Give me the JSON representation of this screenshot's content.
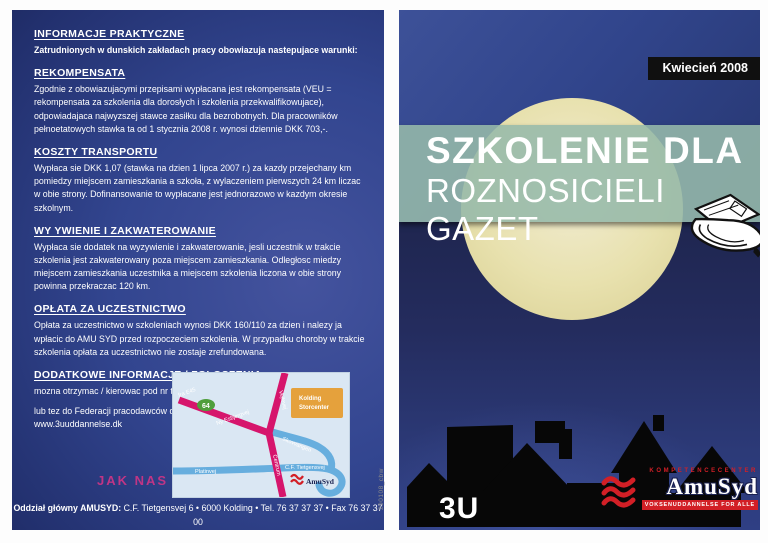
{
  "left_page": {
    "sections": [
      {
        "heading": "INFORMACJE PRAKTYCZNE",
        "body": "Zatrudnionych w dunskich zakładach pracy obowiazuja nastepujace warunki:"
      },
      {
        "heading": "REKOMPENSATA",
        "body": "Zgodnie z obowiazujacymi przepisami wypłacana jest rekompensata (VEU = rekompensata za szkolenia dla dorosłych i szkolenia przekwalifikowujace), odpowiadajaca najwyzszej stawce zasiłku dla bezrobotnych. Dla pracowników pełnoetatowych stawka ta od 1 stycznia 2008 r. wynosi dziennie DKK 703,-."
      },
      {
        "heading": "KOSZTY TRANSPORTU",
        "body": "Wypłaca sie DKK 1,07 (stawka na dzien 1 lipca 2007 r.) za kazdy przejechany km pomiedzy miejscem zamieszkania a szkoła, z wylaczeniem pierwszych 24 km liczac w obie strony. Dofinansowanie to wypłacane jest jednorazowo w kazdym okresie szkolnym."
      },
      {
        "heading": "WY YWIENIE I ZAKWATEROWANIE",
        "body": "Wypłaca sie dodatek na wyzywienie i zakwaterowanie, jesli uczestnik w trakcie szkolenia jest zakwaterowany poza miejscem zamieszkania. Odległosc miedzy miejscem zamieszkania uczestnika a miejscem szkolenia liczona w obie strony powinna przekraczac 120 km."
      },
      {
        "heading": "OPŁATA ZA UCZESTNICTWO",
        "body": "Opłata za uczestnictwo w szkoleniach wynosi DKK 160/110 za dzien i nalezy ja wpłacic do AMU SYD przed rozpoczeciem szkolenia. W przypadku choroby w trakcie szkolenia opłata za uczestnictwo nie zostaje zrefundowana."
      },
      {
        "heading": "DODATKOWE INFORMACJE / ZGŁOSZENIA",
        "body": "mozna otrzymac / kierowac pod nr tel.: 76 37 37 37 lub e-mail: ap@amusyd.dk",
        "body2": "lub tez do Federacji pracodawców dunskich mediów pod nr tel.: 33 97 40 00 • www.3uuddannelse.dk"
      }
    ],
    "find_us": "JAK NAS ZNALEZC",
    "map": {
      "place_box_line1": "Kolding",
      "place_box_line2": "Storcenter",
      "route_badge": "64",
      "roads": {
        "exit": "fra E45",
        "ny_esbjergvej": "Ny Esbjergvej",
        "vejlevej": "Vejlevej",
        "skovvangen": "Skovvangen",
        "platinvej": "Platinvej",
        "cf_tietgensvej": "C.F. Tietgensvej",
        "centrum": "Centrum"
      },
      "logo_text": "AmuSyd"
    },
    "footer": {
      "bold": "Oddział główny AMUSYD:",
      "line1": " C.F. Tietgensvej 6 • 6000 Kolding • Tel. 76 37 37 37 • Fax 76 37 37 00",
      "line2": "info@amusyd.dk • www.amusyd.dk"
    },
    "side_note": "290108_cbw"
  },
  "right_page": {
    "date_badge": "Kwiecień 2008",
    "title_line1": "SZKOLENIE DLA",
    "title_line2": "ROZNOSICIELI GAZET",
    "house_label": "3U",
    "logo": {
      "kompetencecenter": "KOMPETENCECENTER",
      "name": "AmuSyd",
      "tagline": "VOKSENUDDANNELSE FOR ALLE"
    }
  },
  "colors": {
    "page_blue": "#32458f",
    "night_navy": "#232a57",
    "moon_yellow": "#e8e1ae",
    "band_teal": "#96b9aa",
    "accent_magenta": "#c03585",
    "logo_red": "#d21f26",
    "map_road_magenta": "#d6156c",
    "map_road_blue": "#67aede",
    "map_place_orange": "#e5a13c",
    "map_badge_green": "#4f9e3c",
    "badge_black": "#101010"
  }
}
